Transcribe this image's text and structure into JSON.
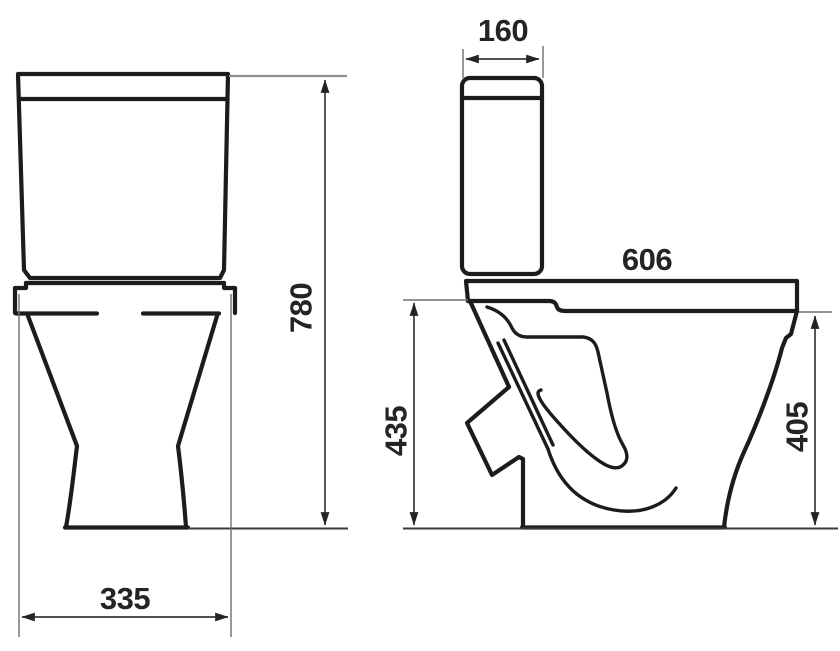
{
  "drawing": {
    "kind": "technical dimension drawing",
    "subject": "close-coupled toilet, front and side elevations",
    "colors": {
      "background": "#ffffff",
      "ink": "#1c1c1c",
      "dimension_ink": "#3a3a3a"
    },
    "dimensions": {
      "front_width": "335",
      "front_height": "780",
      "tank_depth": "160",
      "overall_depth": "606",
      "height_back": "435",
      "height_front": "405"
    }
  }
}
